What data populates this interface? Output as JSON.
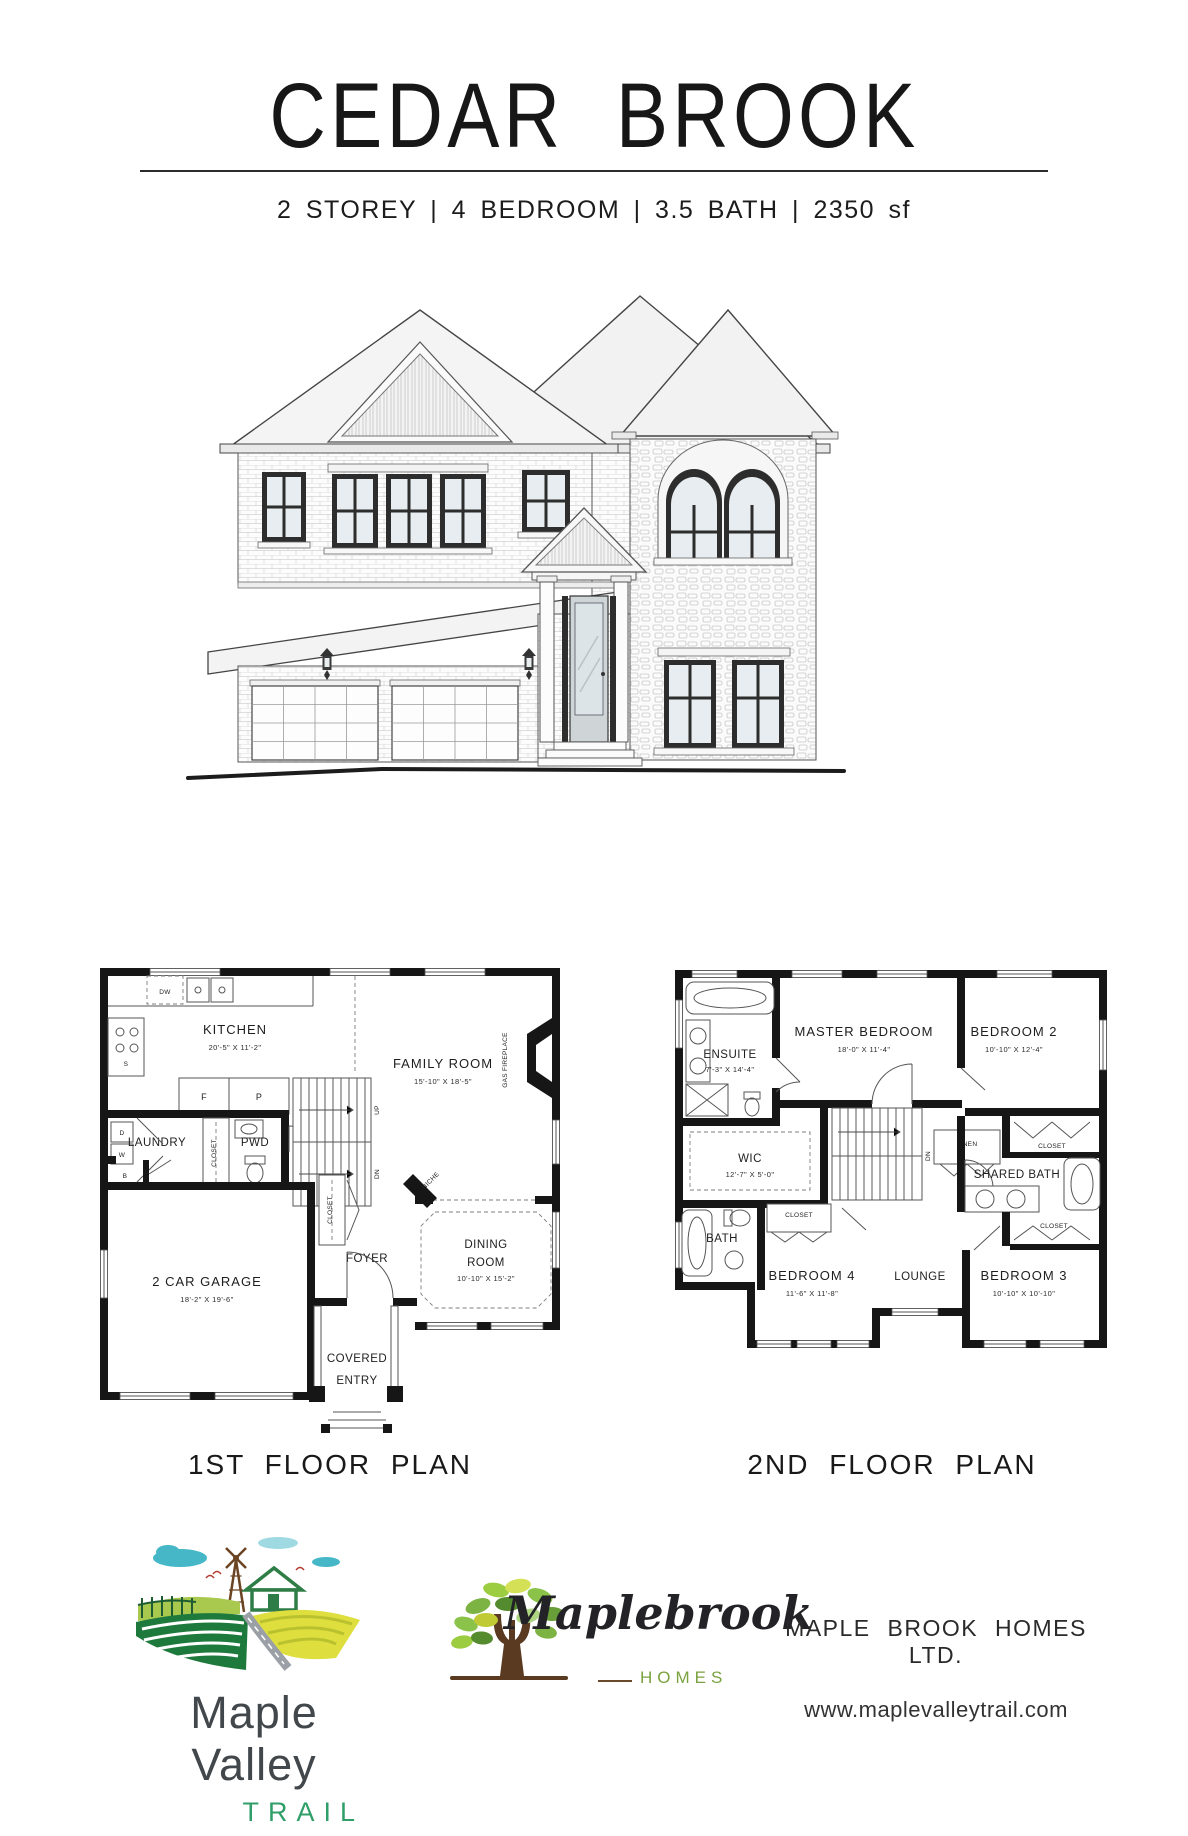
{
  "header": {
    "title": "CEDAR BROOK",
    "subtitle": "2 STOREY | 4 BEDROOM | 3.5 BATH | 2350 sf"
  },
  "floor1": {
    "caption": "1ST FLOOR PLAN",
    "kitchen": "KITCHEN",
    "kitchen_dims": "20'-5\" X 11'-2\"",
    "family": "FAMILY ROOM",
    "family_dims": "15'-10\" X 18'-5\"",
    "garage": "2 CAR GARAGE",
    "garage_dims": "18'-2\" X 19'-6\"",
    "dining1": "DINING",
    "dining2": "ROOM",
    "dining_dims": "10'-10\" X 15'-2\"",
    "laundry": "LAUNDRY",
    "pwd": "PWD",
    "foyer": "FOYER",
    "covered1": "COVERED",
    "covered2": "ENTRY",
    "closet_hall": "CLOSET",
    "closet_foyer": "CLOSET",
    "niche": "NICHE",
    "gas_fireplace": "GAS FIREPLACE",
    "up": "UP",
    "dn": "DN",
    "dw": "DW",
    "s": "S",
    "f": "F",
    "p": "P",
    "b": "B",
    "w": "W",
    "d": "D"
  },
  "floor2": {
    "caption": "2ND FLOOR PLAN",
    "master": "MASTER BEDROOM",
    "master_dims": "18'-0\" X 11'-4\"",
    "bed2": "BEDROOM 2",
    "bed2_dims": "10'-10\" X 12'-4\"",
    "bed3": "BEDROOM 3",
    "bed3_dims": "10'-10\" X 10'-10\"",
    "bed4": "BEDROOM 4",
    "bed4_dims": "11'-6\" X 11'-8\"",
    "ensuite": "ENSUITE",
    "ensuite_dims": "7'-3\" X 14'-4\"",
    "wic": "WIC",
    "wic_dims": "12'-7\" X 5'-0\"",
    "shared_bath": "SHARED BATH",
    "bath": "BATH",
    "lounge": "LOUNGE",
    "linen": "LINEN",
    "closet_b2": "CLOSET",
    "closet_b3": "CLOSET",
    "closet_b4": "CLOSET",
    "dn": "DN"
  },
  "footer": {
    "brand_name": "Maple Valley",
    "brand_sub": "TRAIL",
    "builder_script": "Maplebrook",
    "builder_sub": "HOMES",
    "company": "MAPLE BROOK HOMES LTD.",
    "website": "www.maplevalleytrail.com"
  },
  "colors": {
    "trail_green": "#2f9e68",
    "homes_green": "#7aa23f",
    "ink": "#1d1d1d"
  }
}
